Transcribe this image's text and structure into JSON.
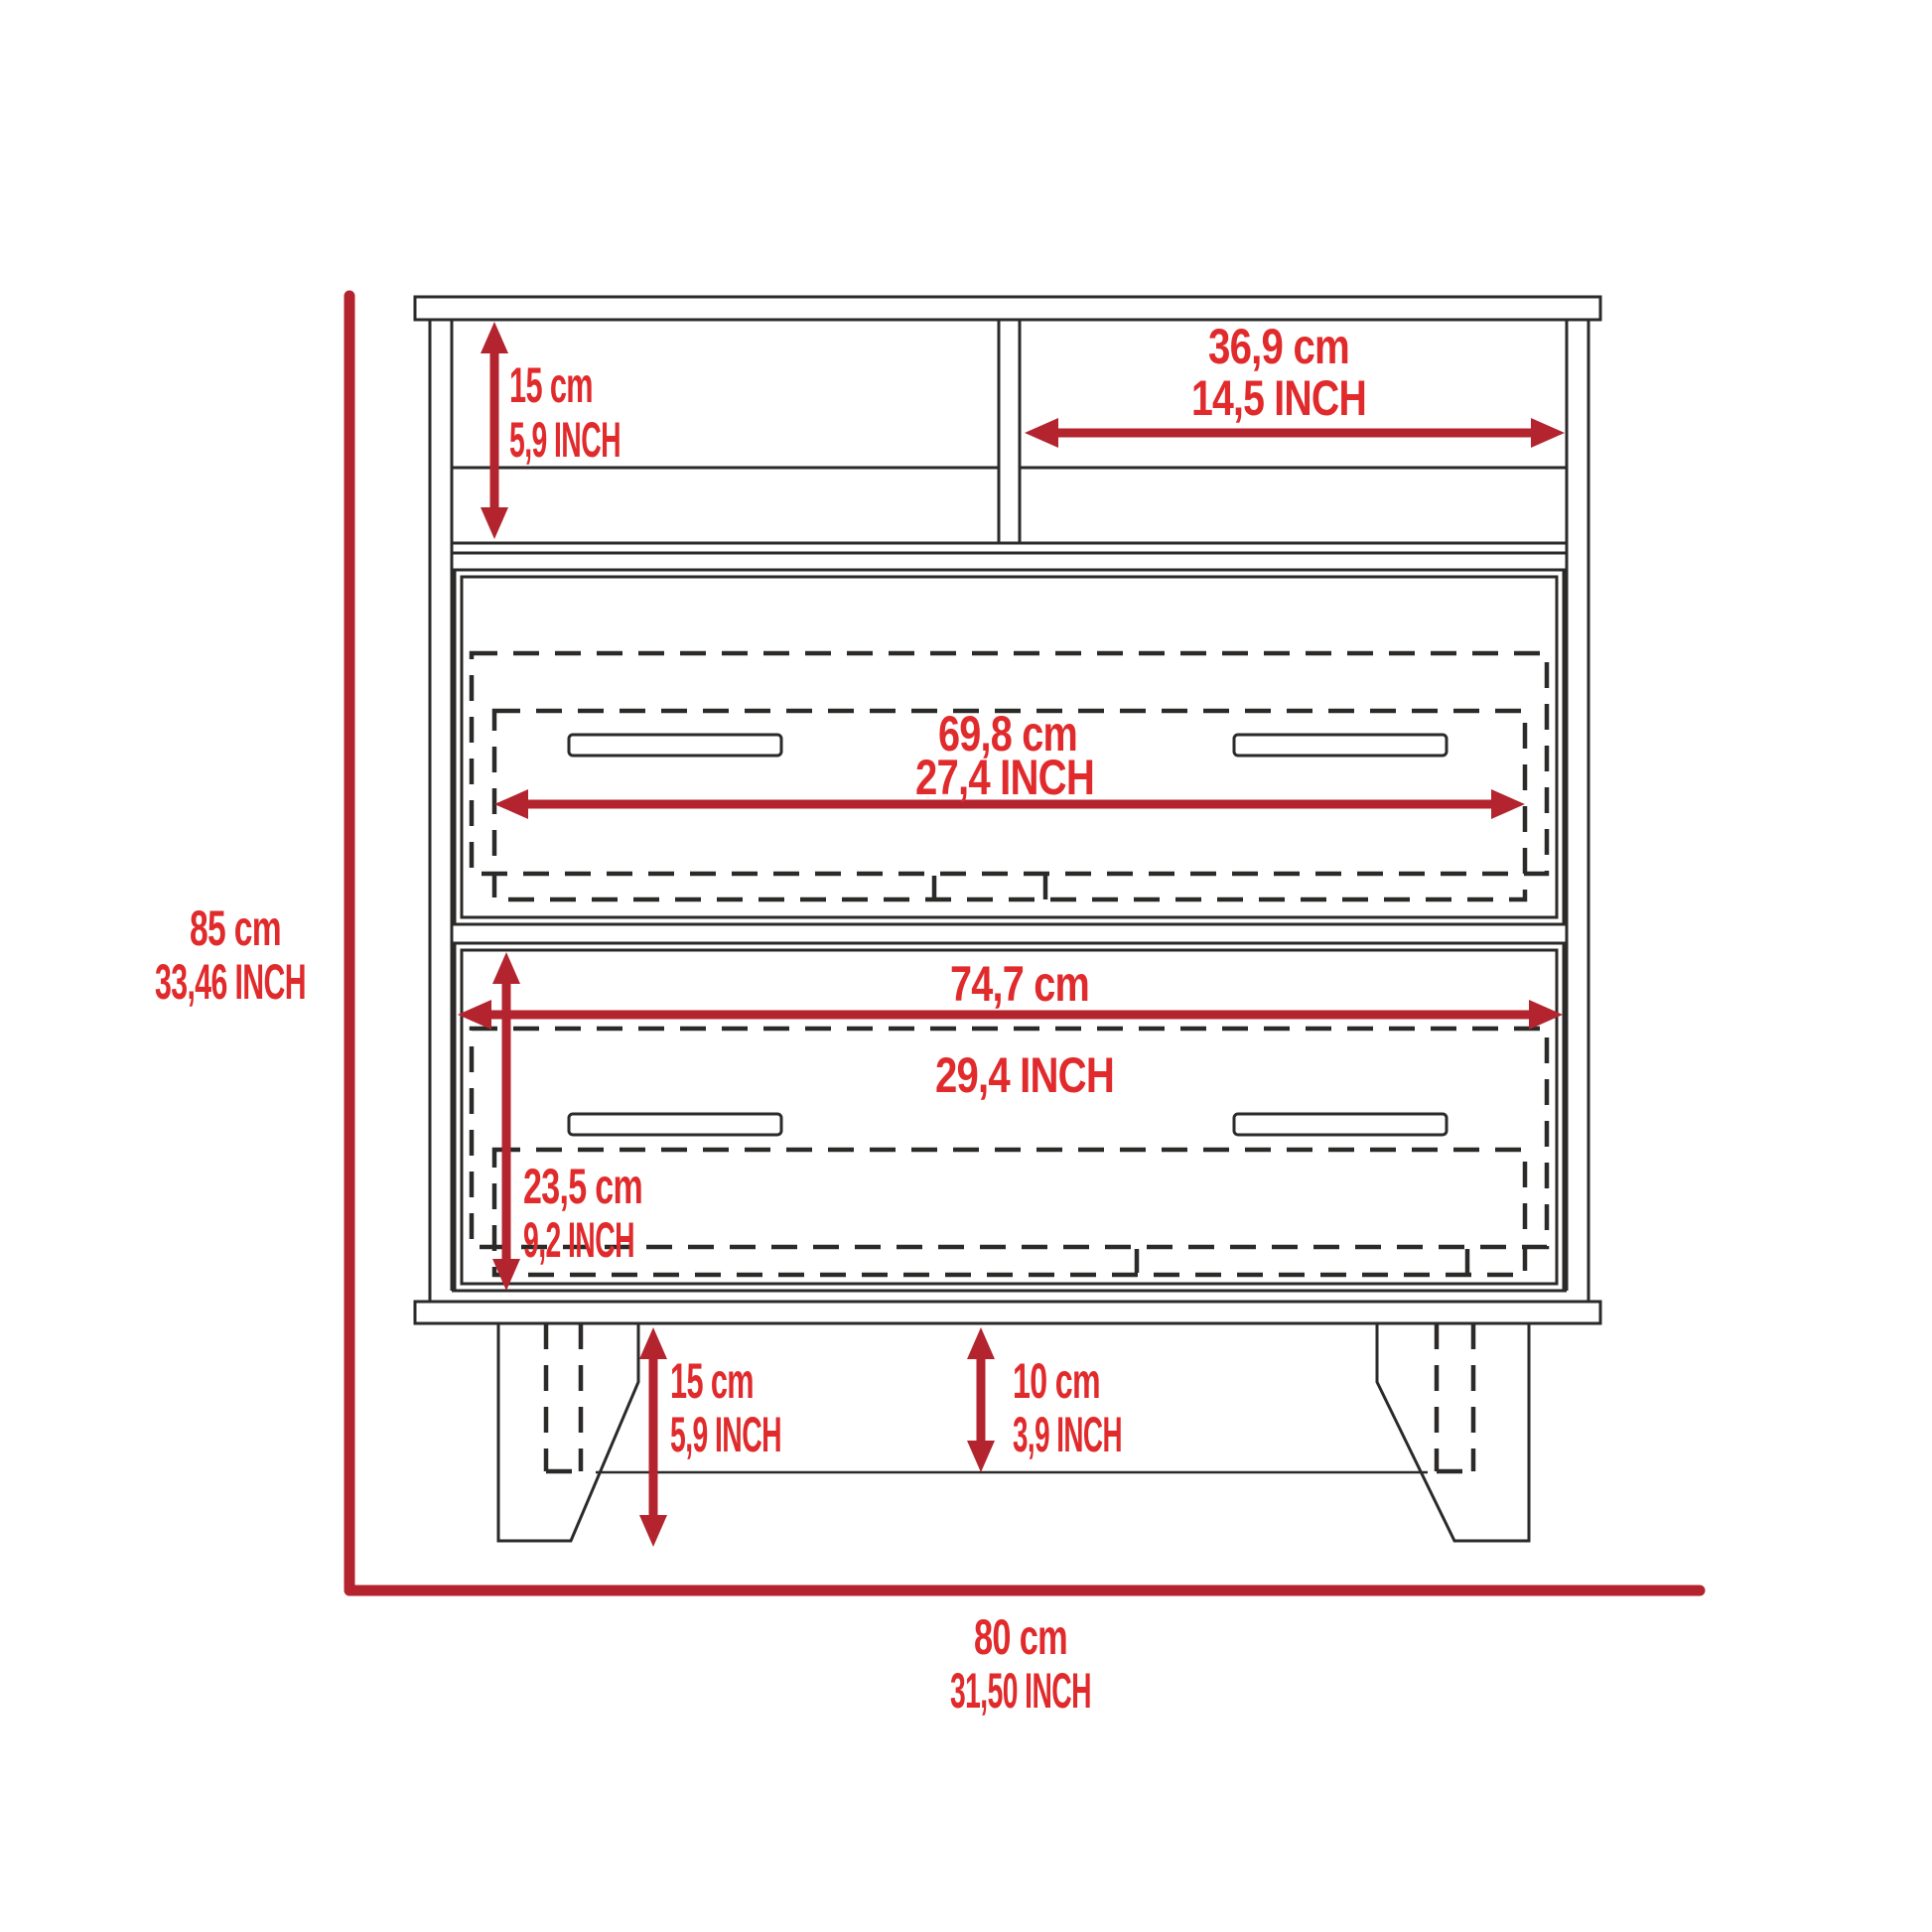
{
  "diagram": {
    "type": "furniture-technical-drawing",
    "colors": {
      "dimension_line_red": "#b3242e",
      "dimension_text_red": "#e02a2c",
      "outline_black": "#2b2a29",
      "background": "#ffffff"
    },
    "dimensions": {
      "shelf_height": {
        "cm": "15 cm",
        "inch": "5,9 INCH"
      },
      "shelf_width": {
        "cm": "36,9 cm",
        "inch": "14,5 INCH"
      },
      "drawer_top_width": {
        "cm": "69,8 cm",
        "inch": "27,4 INCH"
      },
      "drawer_bottom_width": {
        "cm": "74,7 cm",
        "inch": "29,4 INCH"
      },
      "drawer_bottom_height": {
        "cm": "23,5 cm",
        "inch": "9,2 INCH"
      },
      "overall_height": {
        "cm": "85 cm",
        "inch": "33,46 INCH"
      },
      "overall_width": {
        "cm": "80 cm",
        "inch": "31,50 INCH"
      },
      "leg_height": {
        "cm": "15 cm",
        "inch": "5,9 INCH"
      },
      "base_clearance": {
        "cm": "10 cm",
        "inch": "3,9 INCH"
      }
    }
  }
}
